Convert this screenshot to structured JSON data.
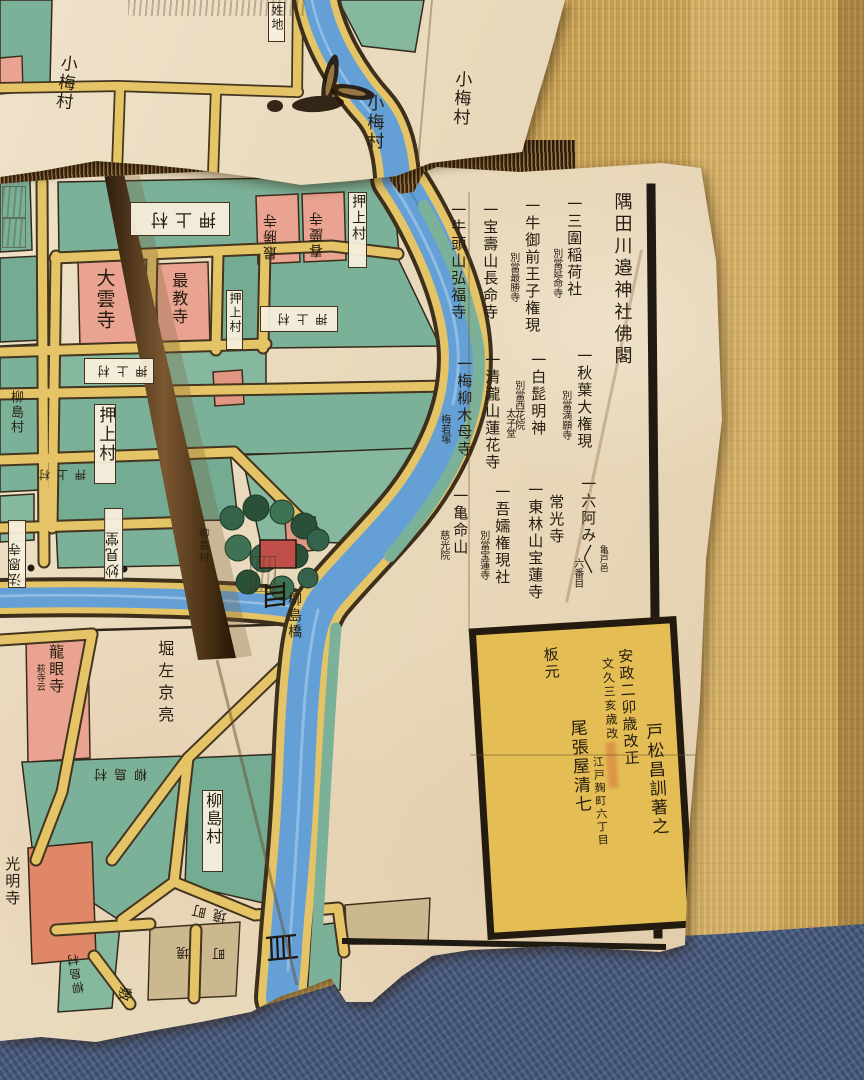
{
  "colors": {
    "paper": "#e9dabd",
    "block_teal": "#7cb199",
    "temple_pink": "#e9a390",
    "road_yellow": "#e4c466",
    "river_blue": "#64a0d6",
    "ink_black": "#241c10",
    "tatami_tan": "#c9a35b",
    "fabric_blue": "#46587a",
    "colophon_yellow": "#e4bd54"
  },
  "map": {
    "list_title": "隅田川邉神社佛閣",
    "list_entries": [
      {
        "main": "一三圍稲荷社",
        "sub": "別當延命寺"
      },
      {
        "main": "一牛御前王子権現",
        "sub": "別當最勝寺"
      },
      {
        "main": "一宝壽山長命寺"
      },
      {
        "main": "一牛頭山弘福寺"
      },
      {
        "main": "一秋葉大権現",
        "sub": "別當満願寺"
      },
      {
        "main": "一白髭明神",
        "sub": "別當西花院"
      },
      {
        "main": "一清瀧山蓮花寺",
        "subr": "太子堂"
      },
      {
        "main": "一梅柳木母寺",
        "sub": "梅若塚"
      },
      {
        "main": "一六阿み〱",
        "sub": "六番目",
        "subr": "亀戸邑"
      },
      {
        "main": "常光寺"
      },
      {
        "main": "一東林山宝蓮寺"
      },
      {
        "main": "一吾嬬権現社",
        "sub": "別當宝蓮寺"
      },
      {
        "main": "一亀命山",
        "sub": "慈光院"
      }
    ],
    "colophon": {
      "revised1": "安政二卯歳改正",
      "revised2": "文久三亥歳改",
      "author": "戸松昌訓著之",
      "address": "江戸麹町六丁目",
      "publisher": "尾張屋清七",
      "publisher_note": "板元"
    },
    "places": {
      "komumemura": "小梅村",
      "hyakushochi": "姓地",
      "oshiagemura": "押上村",
      "daiunji": "大雲寺",
      "saikyoji": "最教寺",
      "shunkeiji": "春慶寺",
      "saishoji": "最勝寺",
      "myokendo": "妙見堂",
      "hoonji": "法恩寺",
      "yanagishimamura": "柳島村",
      "yanagishimabashi": "柳島橋",
      "hori_sakyonosuke": "堀左京亮",
      "ryuganji": "龍眼寺",
      "hagidera_note": "萩寺云",
      "komyoji": "光明寺",
      "sakaimachi": "境町",
      "sakai": "境",
      "machi": "町",
      "shiki": "敷"
    }
  }
}
